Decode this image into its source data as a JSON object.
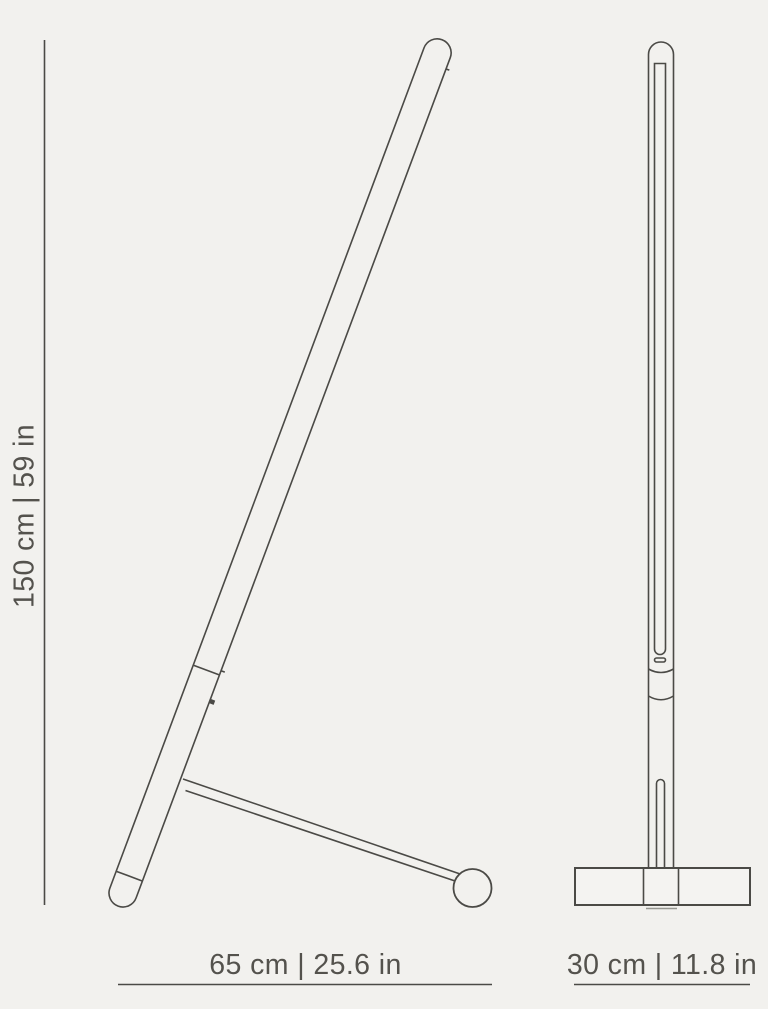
{
  "colors": {
    "background": "#f2f1ee",
    "line": "#4b4a46",
    "text": "#54524d"
  },
  "diagram": {
    "type": "product-dimension-drawing",
    "subject": "linear floor lamp, two orthographic views (tilted side view and front view)"
  },
  "dimensions": {
    "height": {
      "label": "150 cm | 59 in",
      "cm": "150",
      "in": "59"
    },
    "depth": {
      "label": "65 cm | 25.6 in",
      "cm": "65",
      "in": "25.6"
    },
    "width": {
      "label": "30 cm | 11.8 in",
      "cm": "30",
      "in": "11.8"
    }
  }
}
